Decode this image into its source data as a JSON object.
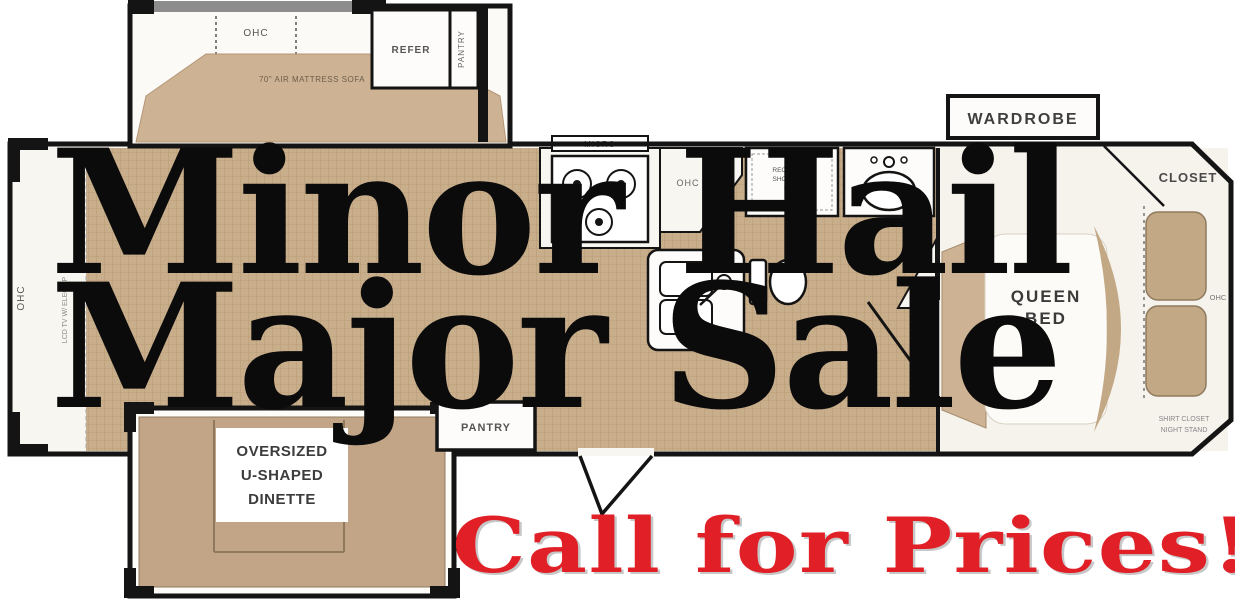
{
  "promo": {
    "line1": "Minor Hail",
    "line2": "Major Sale",
    "cta": "Call for Prices!",
    "text_color": "#0b0b0b",
    "cta_color": "#e01f26"
  },
  "floorplan": {
    "front": {
      "ohc": "OHC",
      "tv": "LCD TV W/ ELEC FP"
    },
    "sofa_slide": {
      "ohc": "OHC",
      "sofa": "70\" AIR MATTRESS SOFA"
    },
    "kitchen": {
      "refer": "REFER",
      "pantry_top": "PANTRY",
      "micro": "MICRO",
      "ohc": "OHC",
      "pantry_bottom": "PANTRY"
    },
    "bath": {
      "shower_line1": "RECTANGLE",
      "shower_line2": "SHOWER W/",
      "shower_line3": "SEAT"
    },
    "bedroom": {
      "wardrobe": "WARDROBE",
      "closet": "CLOSET",
      "bed_line1": "QUEEN",
      "bed_line2": "BED",
      "ohc": "OHC",
      "corner_line1": "SHIRT CLOSET",
      "corner_line2": "NIGHT STAND"
    },
    "dinette": {
      "line1": "OVERSIZED",
      "line2": "U-SHAPED",
      "line3": "DINETTE"
    },
    "colors": {
      "floor": "#c9ae8c",
      "furniture": "#c3a886",
      "wall": "#141414",
      "promo_red": "#e01f26"
    }
  }
}
